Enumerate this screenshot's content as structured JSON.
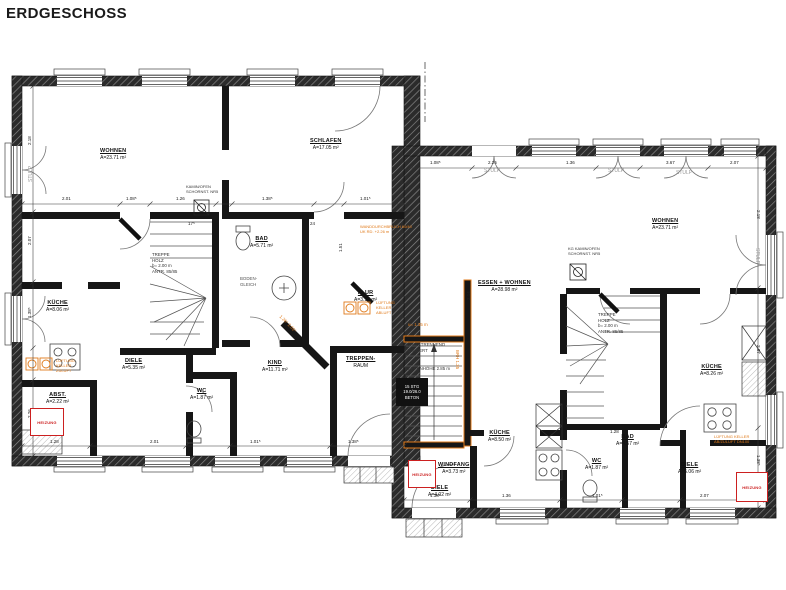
{
  "title": "ERDGESCHOSS",
  "colors": {
    "wall": "#1a1a1a",
    "hatch_line": "#8a8a8a",
    "annotation_red": "#cc2020",
    "annotation_orange": "#e07a1a",
    "dim_text": "#222222"
  },
  "rooms": [
    {
      "name": "WOHNEN",
      "area": "A=23.71 m²",
      "x": 100,
      "y": 148
    },
    {
      "name": "SCHLAFEN",
      "area": "A=17.05 m²",
      "x": 310,
      "y": 138
    },
    {
      "name": "KÜCHE",
      "area": "A=8.06 m²",
      "x": 46,
      "y": 300
    },
    {
      "name": "DIELE",
      "area": "A=5.35 m²",
      "x": 122,
      "y": 358
    },
    {
      "name": "WC",
      "area": "A=1.87 m²",
      "x": 190,
      "y": 388
    },
    {
      "name": "ABST.",
      "area": "A=2.22 m²",
      "x": 46,
      "y": 392
    },
    {
      "name": "BAD",
      "area": "A=5.71 m²",
      "x": 250,
      "y": 236
    },
    {
      "name": "KIND",
      "area": "A=11.71 m²",
      "x": 262,
      "y": 360
    },
    {
      "name": "FLUR",
      "area": "A=3.12 m²",
      "x": 354,
      "y": 290
    },
    {
      "name": "TREPPEN-",
      "area": "RAUM",
      "x": 346,
      "y": 356
    },
    {
      "name": "ESSEN + WOHNEN",
      "area": "A=28.98 m²",
      "x": 478,
      "y": 280
    },
    {
      "name": "WOHNEN",
      "area": "A=23.71 m²",
      "x": 652,
      "y": 218
    },
    {
      "name": "KÜCHE",
      "area": "A=8.50 m²",
      "x": 488,
      "y": 430
    },
    {
      "name": "KÜCHE",
      "area": "A=8.26 m²",
      "x": 700,
      "y": 364
    },
    {
      "name": "WC",
      "area": "A=1.87 m²",
      "x": 585,
      "y": 458
    },
    {
      "name": "WINDFANG",
      "area": "A=3.73 m²",
      "x": 438,
      "y": 462
    },
    {
      "name": "DIELE",
      "area": "A=4.02 m²",
      "x": 428,
      "y": 485
    },
    {
      "name": "BAD",
      "area": "A=4.57 m²",
      "x": 616,
      "y": 434
    },
    {
      "name": "DIELE",
      "area": "A=5.06 m²",
      "x": 678,
      "y": 462
    }
  ],
  "notes": [
    {
      "text": "STULP",
      "x": 28,
      "y": 182,
      "rot": -90,
      "color": "#999999",
      "fs": 5
    },
    {
      "text": "STULP",
      "x": 484,
      "y": 168,
      "color": "#999999",
      "fs": 5
    },
    {
      "text": "STULP",
      "x": 608,
      "y": 168,
      "color": "#999999",
      "fs": 5
    },
    {
      "text": "STULP",
      "x": 676,
      "y": 170,
      "color": "#999999",
      "fs": 5
    },
    {
      "text": "STULP",
      "x": 760,
      "y": 248,
      "rot": 90,
      "color": "#999999",
      "fs": 5
    },
    {
      "text": "TREPPE\nHOLZ\nb= 2.00 m\nANTR. 85/85",
      "x": 152,
      "y": 252,
      "color": "#333333",
      "fs": 4.4
    },
    {
      "text": "TREPPE\nHOLZ\nb= 2.00 m\nANTR. 85/85",
      "x": 598,
      "y": 312,
      "color": "#333333",
      "fs": 4.4
    },
    {
      "text": "SCHALLTRENNEND\nGELAGERT",
      "x": 404,
      "y": 342,
      "color": "#333333",
      "fs": 4.4
    },
    {
      "text": "TREPPENHÖHE  2.85 m",
      "x": 402,
      "y": 366,
      "color": "#333333",
      "fs": 4.4
    },
    {
      "text": "BODEN-\nGLEICH",
      "x": 240,
      "y": 276,
      "color": "#555555",
      "fs": 4.4
    },
    {
      "text": "KAMIN/OFEN\nSCHORNST. NR5",
      "x": 186,
      "y": 184,
      "color": "#333333",
      "fs": 4
    },
    {
      "text": "KG KAMIN/OFEN\nSCHORNST. NR5",
      "x": 568,
      "y": 246,
      "color": "#333333",
      "fs": 4
    },
    {
      "text": "WANDDURCHBRUCH 60/40\nUK RD. +2.26 m",
      "x": 360,
      "y": 224,
      "color": "#e07a1a",
      "fs": 4
    },
    {
      "text": "LÜFTUNG\nKELLER\nZULUFT",
      "x": 56,
      "y": 358,
      "color": "#e07a1a",
      "fs": 4
    },
    {
      "text": "LÜFTUNG\nKELLER\nABLUFT",
      "x": 376,
      "y": 300,
      "color": "#e07a1a",
      "fs": 4
    },
    {
      "text": "LÜFTUNG KELLER\nAB/ZULUFT DN100",
      "x": 714,
      "y": 434,
      "color": "#e07a1a",
      "fs": 4
    },
    {
      "text": "u= 1.35 m",
      "x": 408,
      "y": 322,
      "color": "#e07a1a",
      "fs": 4.4
    },
    {
      "text": "BRH 1.35",
      "x": 460,
      "y": 350,
      "rot": 90,
      "color": "#e07a1a",
      "fs": 4.4
    },
    {
      "text": "1.26⁵   2.01⁵",
      "x": 282,
      "y": 314,
      "rot": 45,
      "color": "#e07a1a",
      "fs": 4.4
    }
  ],
  "spec_boxes": [
    {
      "label": "15 STG\n19.0/26.0\nBETON",
      "x": 396,
      "y": 378,
      "w": 32,
      "h": 28
    }
  ],
  "heizung_boxes": [
    {
      "label": "HEIZUNG",
      "x": 30,
      "y": 408,
      "w": 32,
      "h": 26
    },
    {
      "label": "HEIZUNG",
      "x": 408,
      "y": 460,
      "w": 26,
      "h": 26
    },
    {
      "label": "HEIZUNG",
      "x": 736,
      "y": 472,
      "w": 30,
      "h": 28
    }
  ],
  "dims": [
    {
      "t": "2.01",
      "x": 62,
      "y": 196
    },
    {
      "t": "1.08⁵",
      "x": 126,
      "y": 196
    },
    {
      "t": "1.26",
      "x": 176,
      "y": 196
    },
    {
      "t": "1.38⁵",
      "x": 262,
      "y": 196
    },
    {
      "t": "1.01⁵",
      "x": 360,
      "y": 196
    },
    {
      "t": "2.18",
      "x": 27,
      "y": 145,
      "rot": -90
    },
    {
      "t": "2.07",
      "x": 27,
      "y": 245,
      "rot": -90
    },
    {
      "t": "1.38⁵",
      "x": 27,
      "y": 318,
      "rot": -90
    },
    {
      "t": "2.26",
      "x": 27,
      "y": 418,
      "rot": -90
    },
    {
      "t": "1.08⁵",
      "x": 430,
      "y": 160
    },
    {
      "t": "2.26",
      "x": 488,
      "y": 160
    },
    {
      "t": "1.36",
      "x": 566,
      "y": 160
    },
    {
      "t": "3.67",
      "x": 666,
      "y": 160
    },
    {
      "t": "2.07",
      "x": 730,
      "y": 160
    },
    {
      "t": "2.18",
      "x": 761,
      "y": 210,
      "rot": 90
    },
    {
      "t": "2.07",
      "x": 761,
      "y": 345,
      "rot": 90
    },
    {
      "t": "1.38⁵",
      "x": 761,
      "y": 455,
      "rot": 90
    },
    {
      "t": "1.28",
      "x": 50,
      "y": 439
    },
    {
      "t": "2.01",
      "x": 150,
      "y": 439
    },
    {
      "t": "1.01⁵",
      "x": 250,
      "y": 439
    },
    {
      "t": "1.38⁵",
      "x": 348,
      "y": 439
    },
    {
      "t": "1.38⁵",
      "x": 430,
      "y": 493
    },
    {
      "t": "1.36",
      "x": 502,
      "y": 493
    },
    {
      "t": "1.01⁵",
      "x": 592,
      "y": 493
    },
    {
      "t": "2.07",
      "x": 700,
      "y": 493
    },
    {
      "t": "17⁵",
      "x": 188,
      "y": 221
    },
    {
      "t": "24",
      "x": 310,
      "y": 221
    },
    {
      "t": "1.28",
      "x": 610,
      "y": 429
    },
    {
      "t": "2.14",
      "x": 466,
      "y": 300,
      "rot": -90
    },
    {
      "t": "1.51",
      "x": 338,
      "y": 252,
      "rot": -90
    }
  ]
}
